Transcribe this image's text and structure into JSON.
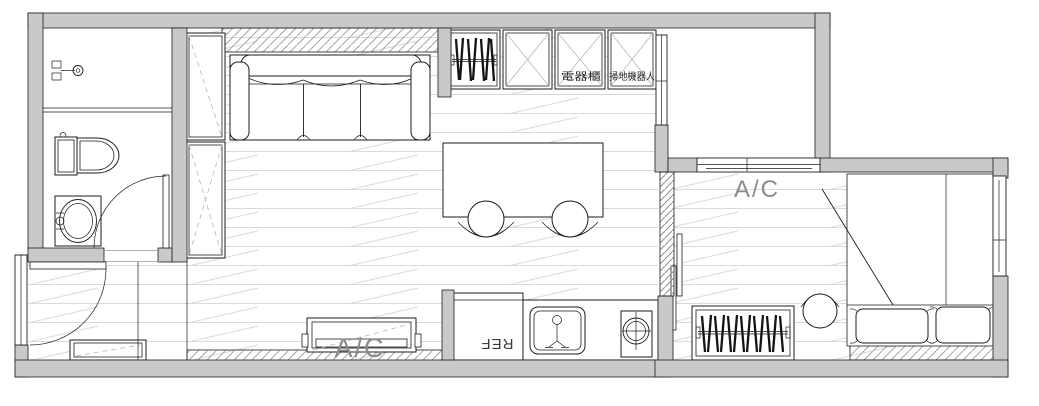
{
  "plan": {
    "labels": {
      "appliance_cabinet": "電器櫃",
      "robot_vacuum_cabinet": "掃地機器人",
      "ac_unit_living": "A/C",
      "ac_unit_bedroom": "A/C",
      "refrigerator": "REF"
    },
    "colors": {
      "wall_fill": "#c9c9c9",
      "line": "#1e1e1e",
      "light_line": "#bdbdbd",
      "floor_line": "#dadada",
      "hatch_line": "#a6a6a6",
      "wall_hatch_line": "#8f8f8f",
      "label_gray": "#8c8c8c",
      "label_dark": "#222222"
    },
    "rooms": {
      "bathroom": {
        "fixtures": [
          "shower-mixer-icon",
          "toilet-icon",
          "washbasin-icon",
          "swing-door"
        ]
      },
      "entry": {
        "fixtures": [
          "entry-swing-door",
          "shoe-bench"
        ]
      },
      "living_dining": {
        "fixtures": [
          "tall-cabinet",
          "sofa",
          "hanger-cabinet",
          "storage-cabinets",
          "dining-table",
          "round-chairs",
          "ac-unit"
        ]
      },
      "kitchen": {
        "fixtures": [
          "refrigerator",
          "kitchen-sink-icon",
          "cooktop-icon"
        ]
      },
      "service_balcony": {
        "fixtures": [
          "windows"
        ]
      },
      "bedroom": {
        "fixtures": [
          "sliding-door",
          "wardrobe-hangers",
          "round-chair",
          "double-bed",
          "pillows",
          "window",
          "ac-label"
        ]
      }
    }
  }
}
